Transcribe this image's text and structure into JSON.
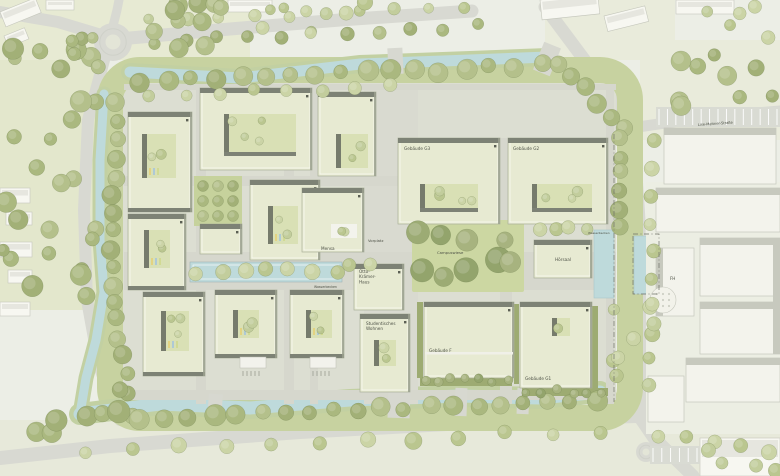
{
  "map": {
    "width": 780,
    "height": 476,
    "labels": {
      "g3": "Gebäude G3",
      "g2": "Gebäude G2",
      "g1": "Gebäude G1",
      "f": "Gebäude F",
      "hoersaal": "Hörsaal",
      "mensa": "Mensa",
      "otto": [
        "Otto-",
        "Krämer-",
        "Haus"
      ],
      "wohnen": [
        "Studentisches",
        "Wohnen"
      ],
      "campuswiese": "Campuswiese",
      "vorplatz": "Vorplatz",
      "wasserbecken_pool": "Wasserbecken",
      "wasserbecken_right": "Wasserbecken",
      "street_lise": "Lise-Meitner-Straße",
      "fh": "FH"
    },
    "palette": {
      "bg": "#eceee6",
      "road": "#d8d9d2",
      "island": "#e3e5d7",
      "ring": "#c7d2a0",
      "interior": "#dcded2",
      "path": "#d6d7cd",
      "plaza": "#d9dad0",
      "water": "#bedadb",
      "bank": "#c2d0a2",
      "bld": "#e7ead2",
      "bld_stroke": "#aab09a",
      "band": "#7d8275",
      "edge": "#9aa08e",
      "court": "#d9e0b5",
      "court_band": "#767b6c",
      "garden": "#c6d29c",
      "wiese": "#ccd7a2",
      "hedge": "#9dab72",
      "ctx": "#f7f7f1",
      "ctx_stroke": "#c5c7bc",
      "ctx_roof": "#c7c9be",
      "ctx_base": "#eceee3",
      "label": "#4c5045",
      "muted": "#8b8d80",
      "boundary": "#6f7268"
    },
    "roads": {
      "lines": [
        {
          "pts": [
            [
              0,
              12
            ],
            [
              58,
              22
            ],
            [
              98,
              34
            ]
          ],
          "w": 12
        },
        {
          "pts": [
            [
              130,
              38
            ],
            [
              230,
              29
            ],
            [
              340,
              20
            ],
            [
              472,
              11
            ]
          ],
          "w": 13
        },
        {
          "pts": [
            [
              113,
              26
            ],
            [
              117,
              10
            ],
            [
              119,
              0
            ]
          ],
          "w": 9
        },
        {
          "pts": [
            [
              104,
              60
            ],
            [
              88,
              120
            ],
            [
              84,
              210
            ],
            [
              87,
              300
            ],
            [
              99,
              366
            ],
            [
              120,
              420
            ]
          ],
          "w": 12
        },
        {
          "pts": [
            [
              0,
              458
            ],
            [
              110,
              446
            ],
            [
              300,
              432
            ],
            [
              520,
              420
            ],
            [
              636,
              416
            ],
            [
              780,
              426
            ]
          ],
          "w": 14
        },
        {
          "pts": [
            [
              545,
              7
            ],
            [
              586,
              62
            ],
            [
              616,
              106
            ],
            [
              631,
              130
            ]
          ],
          "w": 13
        },
        {
          "pts": [
            [
              632,
              130
            ],
            [
              638,
              220
            ],
            [
              639,
              320
            ],
            [
              639,
              416
            ]
          ],
          "w": 15
        },
        {
          "pts": [
            [
              639,
              416
            ],
            [
              654,
              438
            ],
            [
              693,
              476
            ]
          ],
          "w": 13
        },
        {
          "pts": [
            [
              631,
              128
            ],
            [
              700,
              118
            ],
            [
              780,
              111
            ]
          ],
          "w": 11
        }
      ],
      "roundabouts": [
        [
          113,
          42,
          19,
          7.5
        ],
        [
          646,
          452,
          10,
          3.5
        ]
      ]
    },
    "interior": [
      122,
      82,
      494,
      322
    ],
    "ring": {
      "x": 110,
      "y": 70,
      "w": 520,
      "h": 348,
      "rx": 30,
      "sw": 26
    },
    "paths": [
      [
        196,
        84,
        10,
        320
      ],
      [
        284,
        84,
        10,
        320
      ],
      [
        310,
        84,
        8,
        320
      ],
      [
        364,
        84,
        54,
        320
      ],
      [
        500,
        138,
        12,
        266
      ],
      [
        606,
        84,
        8,
        320
      ],
      [
        124,
        84,
        492,
        6
      ],
      [
        124,
        176,
        492,
        10
      ],
      [
        124,
        252,
        492,
        38
      ],
      [
        124,
        390,
        492,
        10
      ]
    ],
    "water": {
      "canals": [
        {
          "pts": [
            [
              130,
              72
            ],
            [
              240,
              78
            ],
            [
              360,
              64
            ],
            [
              470,
              60
            ],
            [
              548,
              57
            ]
          ],
          "w": 11,
          "bank": 18
        },
        {
          "pts": [
            [
              104,
              94
            ],
            [
              100,
              160
            ],
            [
              100,
              240
            ],
            [
              104,
              292
            ]
          ],
          "w": 9,
          "bank": 15
        },
        {
          "pts": [
            [
              104,
              292
            ],
            [
              96,
              340
            ],
            [
              86,
              378
            ],
            [
              80,
              414
            ]
          ],
          "w": 9,
          "bank": 15
        },
        {
          "pts": [
            [
              80,
              414
            ],
            [
              160,
              404
            ],
            [
              250,
              408
            ],
            [
              350,
              400
            ],
            [
              460,
              396
            ],
            [
              540,
              398
            ],
            [
              600,
              392
            ]
          ],
          "w": 13,
          "bank": 22
        }
      ],
      "basins": [
        [
          594,
          230,
          20,
          68
        ],
        [
          634,
          236,
          24,
          58
        ]
      ],
      "pool": [
        190,
        262,
        152,
        20
      ]
    },
    "bridges": [
      [
        388,
        48,
        15,
        26,
        -3
      ],
      [
        538,
        44,
        18,
        30,
        22
      ],
      [
        208,
        394,
        14,
        26,
        4
      ],
      [
        388,
        390,
        22,
        28,
        2
      ],
      [
        455,
        388,
        12,
        28,
        2
      ],
      [
        517,
        388,
        12,
        26,
        2
      ]
    ],
    "garden": [
      194,
      176,
      48,
      50
    ],
    "campuswiese_rect": [
      412,
      220,
      112,
      72
    ],
    "hedges": [
      [
        417,
        302,
        6,
        76
      ],
      [
        514,
        304,
        5,
        80
      ],
      [
        592,
        306,
        6,
        84
      ],
      [
        420,
        378,
        92,
        8
      ],
      [
        522,
        388,
        86,
        8
      ]
    ],
    "buildings": [
      {
        "n": "nw-a",
        "x": 128,
        "y": 112,
        "w": 64,
        "h": 100,
        "band": "tb",
        "cy": [
          142,
          134,
          34,
          44
        ],
        "ct": 2,
        "stripes": true
      },
      {
        "n": "w-b",
        "x": 128,
        "y": 214,
        "w": 58,
        "h": 76,
        "band": "tb",
        "cy": [
          144,
          230,
          26,
          38
        ],
        "ct": 2,
        "stripes": true
      },
      {
        "n": "sw",
        "x": 143,
        "y": 292,
        "w": 62,
        "h": 84,
        "band": "tb",
        "cy": [
          161,
          311,
          28,
          40
        ],
        "ct": 3,
        "stripes": true
      },
      {
        "n": "n-slab",
        "x": 200,
        "y": 88,
        "w": 112,
        "h": 82,
        "band": "t",
        "cy": [
          224,
          114,
          72,
          38
        ],
        "ct": 4,
        "cyBand": true
      },
      {
        "n": "mid-small",
        "x": 200,
        "y": 224,
        "w": 42,
        "h": 30,
        "band": "t"
      },
      {
        "n": "mid-d",
        "x": 250,
        "y": 180,
        "w": 70,
        "h": 80,
        "band": "t",
        "cy": [
          268,
          206,
          30,
          38
        ],
        "ct": 2,
        "stripes": true
      },
      {
        "n": "s-m1",
        "x": 215,
        "y": 290,
        "w": 62,
        "h": 68,
        "band": "tb",
        "cy": [
          233,
          310,
          26,
          28
        ],
        "ct": 2,
        "stripes": true
      },
      {
        "n": "s-m2",
        "x": 290,
        "y": 290,
        "w": 54,
        "h": 68,
        "band": "tb",
        "cy": [
          306,
          310,
          26,
          28
        ],
        "ct": 2,
        "stripes": true
      },
      {
        "n": "n-mid",
        "x": 318,
        "y": 92,
        "w": 58,
        "h": 84,
        "band": "t",
        "cy": [
          336,
          134,
          32,
          34
        ],
        "ct": 2
      },
      {
        "n": "mensa",
        "x": 302,
        "y": 188,
        "w": 62,
        "h": 64,
        "band": "t",
        "cy": [
          331,
          224,
          26,
          14
        ],
        "ct": 2,
        "cyWhite": true
      },
      {
        "n": "otto",
        "x": 354,
        "y": 264,
        "w": 50,
        "h": 46,
        "band": "t"
      },
      {
        "n": "g3",
        "x": 398,
        "y": 138,
        "w": 102,
        "h": 86,
        "band": "t",
        "cy": [
          420,
          184,
          58,
          24
        ],
        "ct": 4,
        "cyBand": true
      },
      {
        "n": "g2",
        "x": 508,
        "y": 138,
        "w": 100,
        "h": 86,
        "band": "t",
        "cy": [
          532,
          184,
          60,
          24
        ],
        "ct": 3,
        "cyBand": true
      },
      {
        "n": "hoersaal",
        "x": 534,
        "y": 240,
        "w": 58,
        "h": 38,
        "band": "t"
      },
      {
        "n": "wohnen",
        "x": 360,
        "y": 314,
        "w": 50,
        "h": 78,
        "band": "t",
        "cy": [
          374,
          340,
          22,
          26
        ],
        "ct": 2
      },
      {
        "n": "f",
        "x": 424,
        "y": 302,
        "w": 90,
        "h": 76,
        "band": "t",
        "gap": 352
      },
      {
        "n": "g1",
        "x": 520,
        "y": 302,
        "w": 72,
        "h": 86,
        "band": "t",
        "cy": [
          552,
          318,
          18,
          18
        ],
        "ct": 1
      }
    ],
    "tree_rows": [
      [
        150,
        20,
        466,
        8,
        10,
        5,
        7,
        1
      ],
      [
        152,
        42,
        476,
        26,
        11,
        5,
        7,
        0
      ],
      [
        142,
        82,
        540,
        66,
        17,
        7,
        11,
        0
      ],
      [
        150,
        94,
        388,
        86,
        8,
        5,
        7,
        1
      ],
      [
        116,
        102,
        112,
        288,
        11,
        7,
        10,
        0
      ],
      [
        112,
        300,
        132,
        414,
        7,
        7,
        10,
        0
      ],
      [
        142,
        418,
        596,
        400,
        20,
        7,
        11,
        0
      ],
      [
        558,
        64,
        624,
        128,
        6,
        7,
        10,
        0
      ],
      [
        618,
        140,
        618,
        224,
        6,
        6,
        9,
        0
      ],
      [
        198,
        271,
        336,
        271,
        7,
        7,
        8,
        1
      ],
      [
        652,
        142,
        652,
        388,
        10,
        6,
        8,
        1
      ],
      [
        84,
        452,
        600,
        430,
        12,
        6,
        9,
        1
      ],
      [
        660,
        434,
        768,
        452,
        5,
        6,
        8,
        1
      ],
      [
        424,
        381,
        508,
        381,
        7,
        4,
        5,
        2
      ],
      [
        526,
        391,
        604,
        391,
        6,
        4,
        5,
        2
      ],
      [
        540,
        229,
        586,
        229,
        4,
        5,
        7,
        1
      ],
      [
        350,
        266,
        368,
        266,
        2,
        6,
        7,
        1
      ]
    ],
    "tree_clusters": [
      [
        0,
        46,
        96,
        252,
        26,
        6,
        11,
        0
      ],
      [
        126,
        0,
        122,
        52,
        10,
        6,
        10,
        0
      ],
      [
        252,
        0,
        118,
        38,
        7,
        5,
        8,
        1
      ],
      [
        56,
        18,
        54,
        56,
        5,
        5,
        8,
        0
      ],
      [
        416,
        224,
        104,
        64,
        9,
        8,
        13,
        2
      ],
      [
        642,
        42,
        136,
        66,
        9,
        6,
        10,
        0
      ],
      [
        684,
        0,
        94,
        38,
        5,
        5,
        8,
        1
      ],
      [
        628,
        288,
        32,
        58,
        3,
        7,
        9,
        1
      ],
      [
        30,
        378,
        92,
        68,
        7,
        8,
        12,
        0
      ],
      [
        704,
        428,
        74,
        44,
        4,
        6,
        8,
        1
      ],
      [
        606,
        306,
        14,
        86,
        4,
        5,
        7,
        1
      ]
    ],
    "context_buildings": [
      [
        0,
        12,
        38,
        16,
        -22
      ],
      [
        4,
        36,
        22,
        12,
        -22
      ],
      [
        46,
        0,
        28,
        10,
        0
      ],
      [
        228,
        0,
        44,
        12,
        0
      ],
      [
        540,
        0,
        58,
        20,
        -6
      ],
      [
        604,
        16,
        42,
        16,
        -14
      ],
      [
        676,
        0,
        58,
        14,
        0
      ],
      [
        0,
        188,
        30,
        15,
        0
      ],
      [
        6,
        212,
        26,
        13,
        0
      ],
      [
        0,
        242,
        32,
        15,
        0
      ],
      [
        8,
        270,
        24,
        13,
        0
      ],
      [
        0,
        302,
        30,
        14,
        0
      ],
      [
        700,
        438,
        80,
        38,
        0
      ]
    ],
    "right_campus": {
      "base": [
        646,
        182,
        134,
        252
      ],
      "buildings": [
        [
          656,
          188,
          124,
          44
        ],
        [
          700,
          238,
          80,
          58
        ],
        [
          656,
          248,
          38,
          68
        ],
        [
          700,
          302,
          80,
          52
        ],
        [
          686,
          358,
          94,
          44
        ],
        [
          648,
          376,
          36,
          46
        ],
        [
          664,
          128,
          112,
          56
        ]
      ],
      "bars": [
        [
          656,
          188,
          124,
          7
        ],
        [
          700,
          238,
          80,
          7
        ],
        [
          700,
          302,
          80,
          7
        ],
        [
          686,
          358,
          94,
          7
        ],
        [
          656,
          248,
          7,
          68
        ],
        [
          664,
          128,
          112,
          7
        ],
        [
          773,
          238,
          7,
          116
        ]
      ],
      "circle": [
        663,
        300,
        13
      ]
    },
    "parking": [
      {
        "x": 656,
        "y": 107,
        "w": 124,
        "h": 20,
        "n": 15
      },
      {
        "x": 650,
        "y": 446,
        "w": 50,
        "h": 18,
        "n": 6
      }
    ],
    "chips": [
      [
        240,
        357,
        26,
        11
      ],
      [
        310,
        357,
        26,
        11
      ]
    ],
    "tick_groups": [
      {
        "x": 243,
        "y": 371,
        "n": 5
      },
      {
        "x": 313,
        "y": 371,
        "n": 5
      }
    ],
    "dashes": {
      "line": [
        614,
        134,
        614,
        402
      ],
      "rect": [
        633,
        234,
        26,
        60
      ]
    },
    "label_items": [
      {
        "key": "g3",
        "x": 404,
        "y": 150,
        "s": 4.2
      },
      {
        "key": "g2",
        "x": 513,
        "y": 150,
        "s": 4.2
      },
      {
        "key": "g1",
        "x": 525,
        "y": 380,
        "s": 4.2
      },
      {
        "key": "f",
        "x": 429,
        "y": 352,
        "s": 4.2
      },
      {
        "key": "hoersaal",
        "x": 563,
        "y": 261,
        "s": 4.2,
        "anchor": "middle"
      },
      {
        "key": "mensa",
        "x": 321,
        "y": 250,
        "s": 4.2
      },
      {
        "key": "otto",
        "x": 359,
        "y": 273,
        "s": 4.2,
        "lines": 3,
        "lh": 5.2
      },
      {
        "key": "wohnen",
        "x": 366,
        "y": 325,
        "s": 4.2,
        "lines": 2,
        "lh": 5.2
      },
      {
        "key": "campuswiese",
        "x": 437,
        "y": 254,
        "s": 3.8,
        "fill": "#6d7459"
      },
      {
        "key": "vorplatz",
        "x": 368,
        "y": 242,
        "s": 3.8,
        "fill": "#8b8d80"
      },
      {
        "key": "wasserbecken_pool",
        "x": 314,
        "y": 288,
        "s": 3.2,
        "fill": "#8b8d80"
      },
      {
        "key": "wasserbecken_right",
        "x": 588,
        "y": 234,
        "s": 3.0,
        "fill": "#8b8d80"
      },
      {
        "key": "street_lise",
        "x": 698,
        "y": 126,
        "s": 3.6,
        "fill": "#85877c",
        "rot": -4
      },
      {
        "key": "fh",
        "x": 670,
        "y": 280,
        "s": 4.0
      }
    ]
  }
}
